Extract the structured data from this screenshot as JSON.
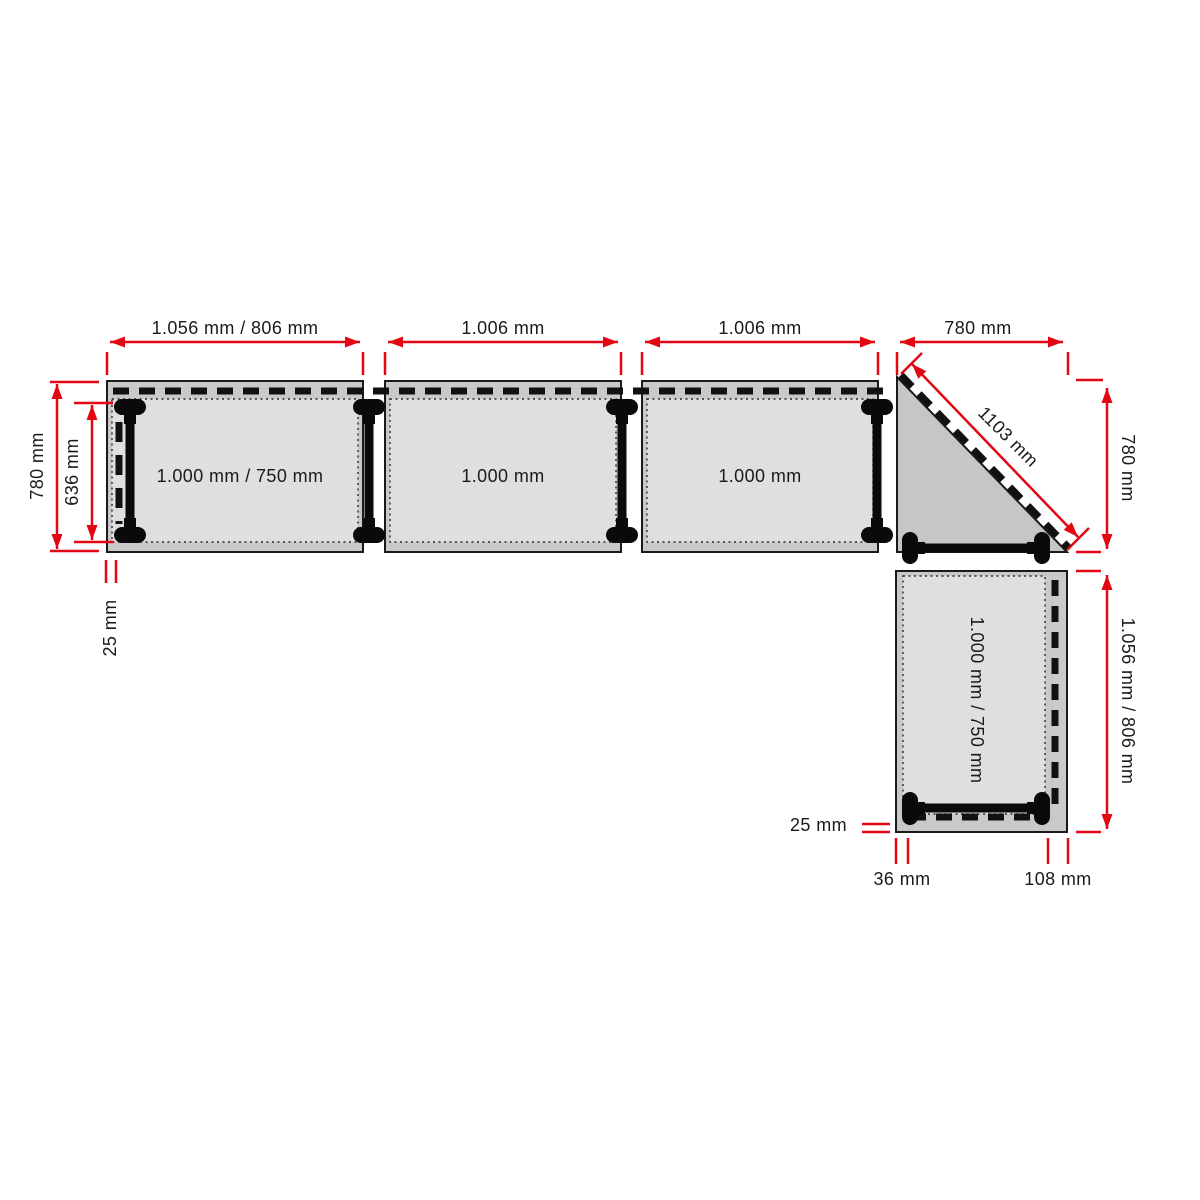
{
  "colors": {
    "dimension_red": "#e30613",
    "ink": "#1a1a1a",
    "tabletop_gray": "#c9c9c9",
    "inset_gray": "#dfdfdf"
  },
  "dims": {
    "top": {
      "t1": "1.056 mm / 806 mm",
      "t2": "1.006 mm",
      "t3": "1.006 mm",
      "corner": "780 mm"
    },
    "left": {
      "outer": "780 mm",
      "inner": "636 mm",
      "gap": "25 mm"
    },
    "right": {
      "corner": "780 mm",
      "diagonal": "1103 mm",
      "t4": "1.056 mm / 806 mm"
    },
    "bottom": {
      "gap": "25 mm",
      "left": "36 mm",
      "right": "108 mm"
    }
  },
  "surfaces": {
    "t1": "1.000 mm / 750 mm",
    "t2": "1.000 mm",
    "t3": "1.000 mm",
    "t4": "1.000 mm / 750 mm"
  }
}
